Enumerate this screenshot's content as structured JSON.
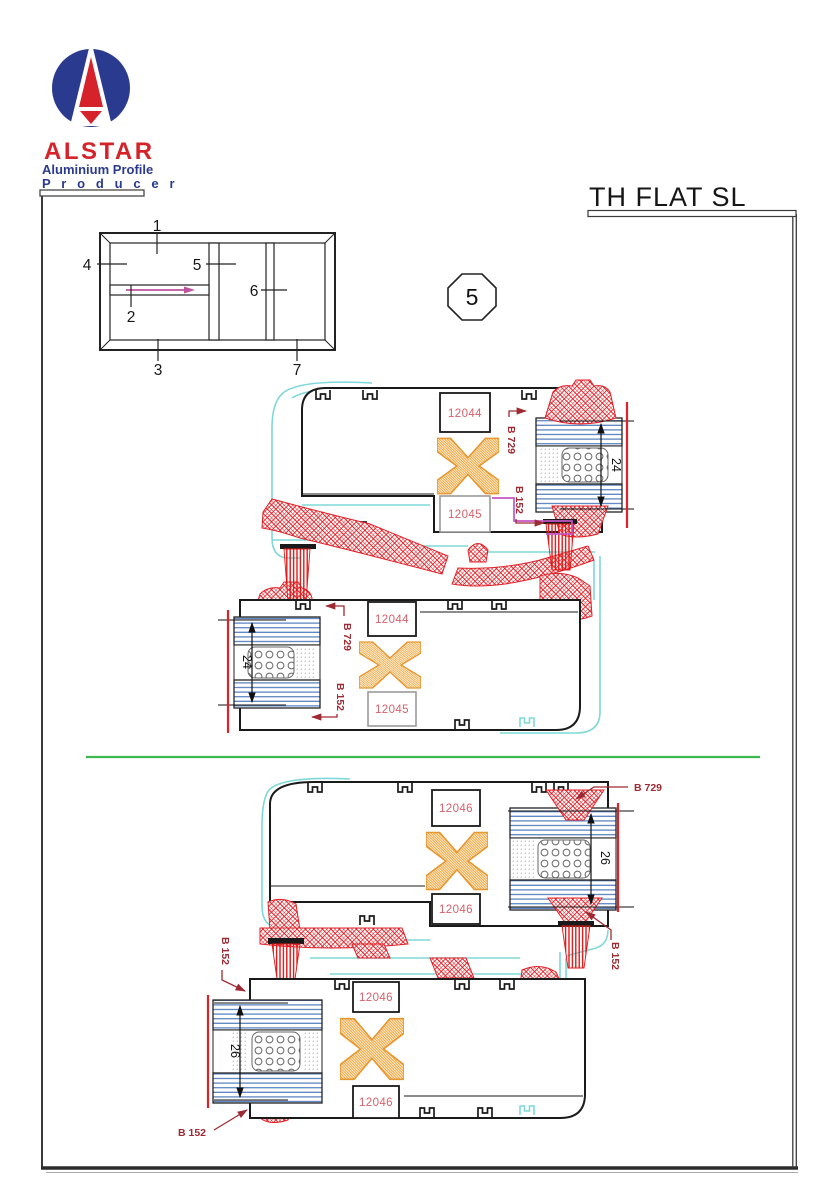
{
  "title": "TH FLAT SL",
  "badge": "5",
  "logo": {
    "brand": "ALSTAR",
    "tagline1": "Aluminium Profile",
    "tagline2": "P r o d u c e r"
  },
  "schematic": {
    "c1": "1",
    "c2": "2",
    "c3": "3",
    "c4": "4",
    "c5": "5",
    "c6": "6",
    "c7": "7"
  },
  "fig1": {
    "upper": {
      "box1": "12044",
      "box2": "12045",
      "b729": "B 729",
      "b152": "B 152",
      "dim": "24"
    },
    "lower": {
      "box1": "12044",
      "box2": "12045",
      "b729": "B 729",
      "b152": "B 152",
      "dim": "24"
    }
  },
  "fig2": {
    "upper": {
      "box1": "12046",
      "box2": "12046",
      "b729": "B 729",
      "b152_right": "B 152",
      "dim": "26"
    },
    "lower": {
      "box1": "12046",
      "box2": "12046",
      "b152_left": "B 152",
      "b152_bottom": "B 152",
      "dim": "26"
    }
  },
  "colors": {
    "accent_red": "#E02128",
    "label_red": "#D5606B",
    "leader_red": "#9E2A33",
    "cyan": "#7FD8D8",
    "orange": "#F0A030",
    "magenta": "#C455C4",
    "glass_blue": "#5E86C2",
    "green": "#3CB94E",
    "navy": "#2A3B8F",
    "brand_red": "#D6232B"
  }
}
